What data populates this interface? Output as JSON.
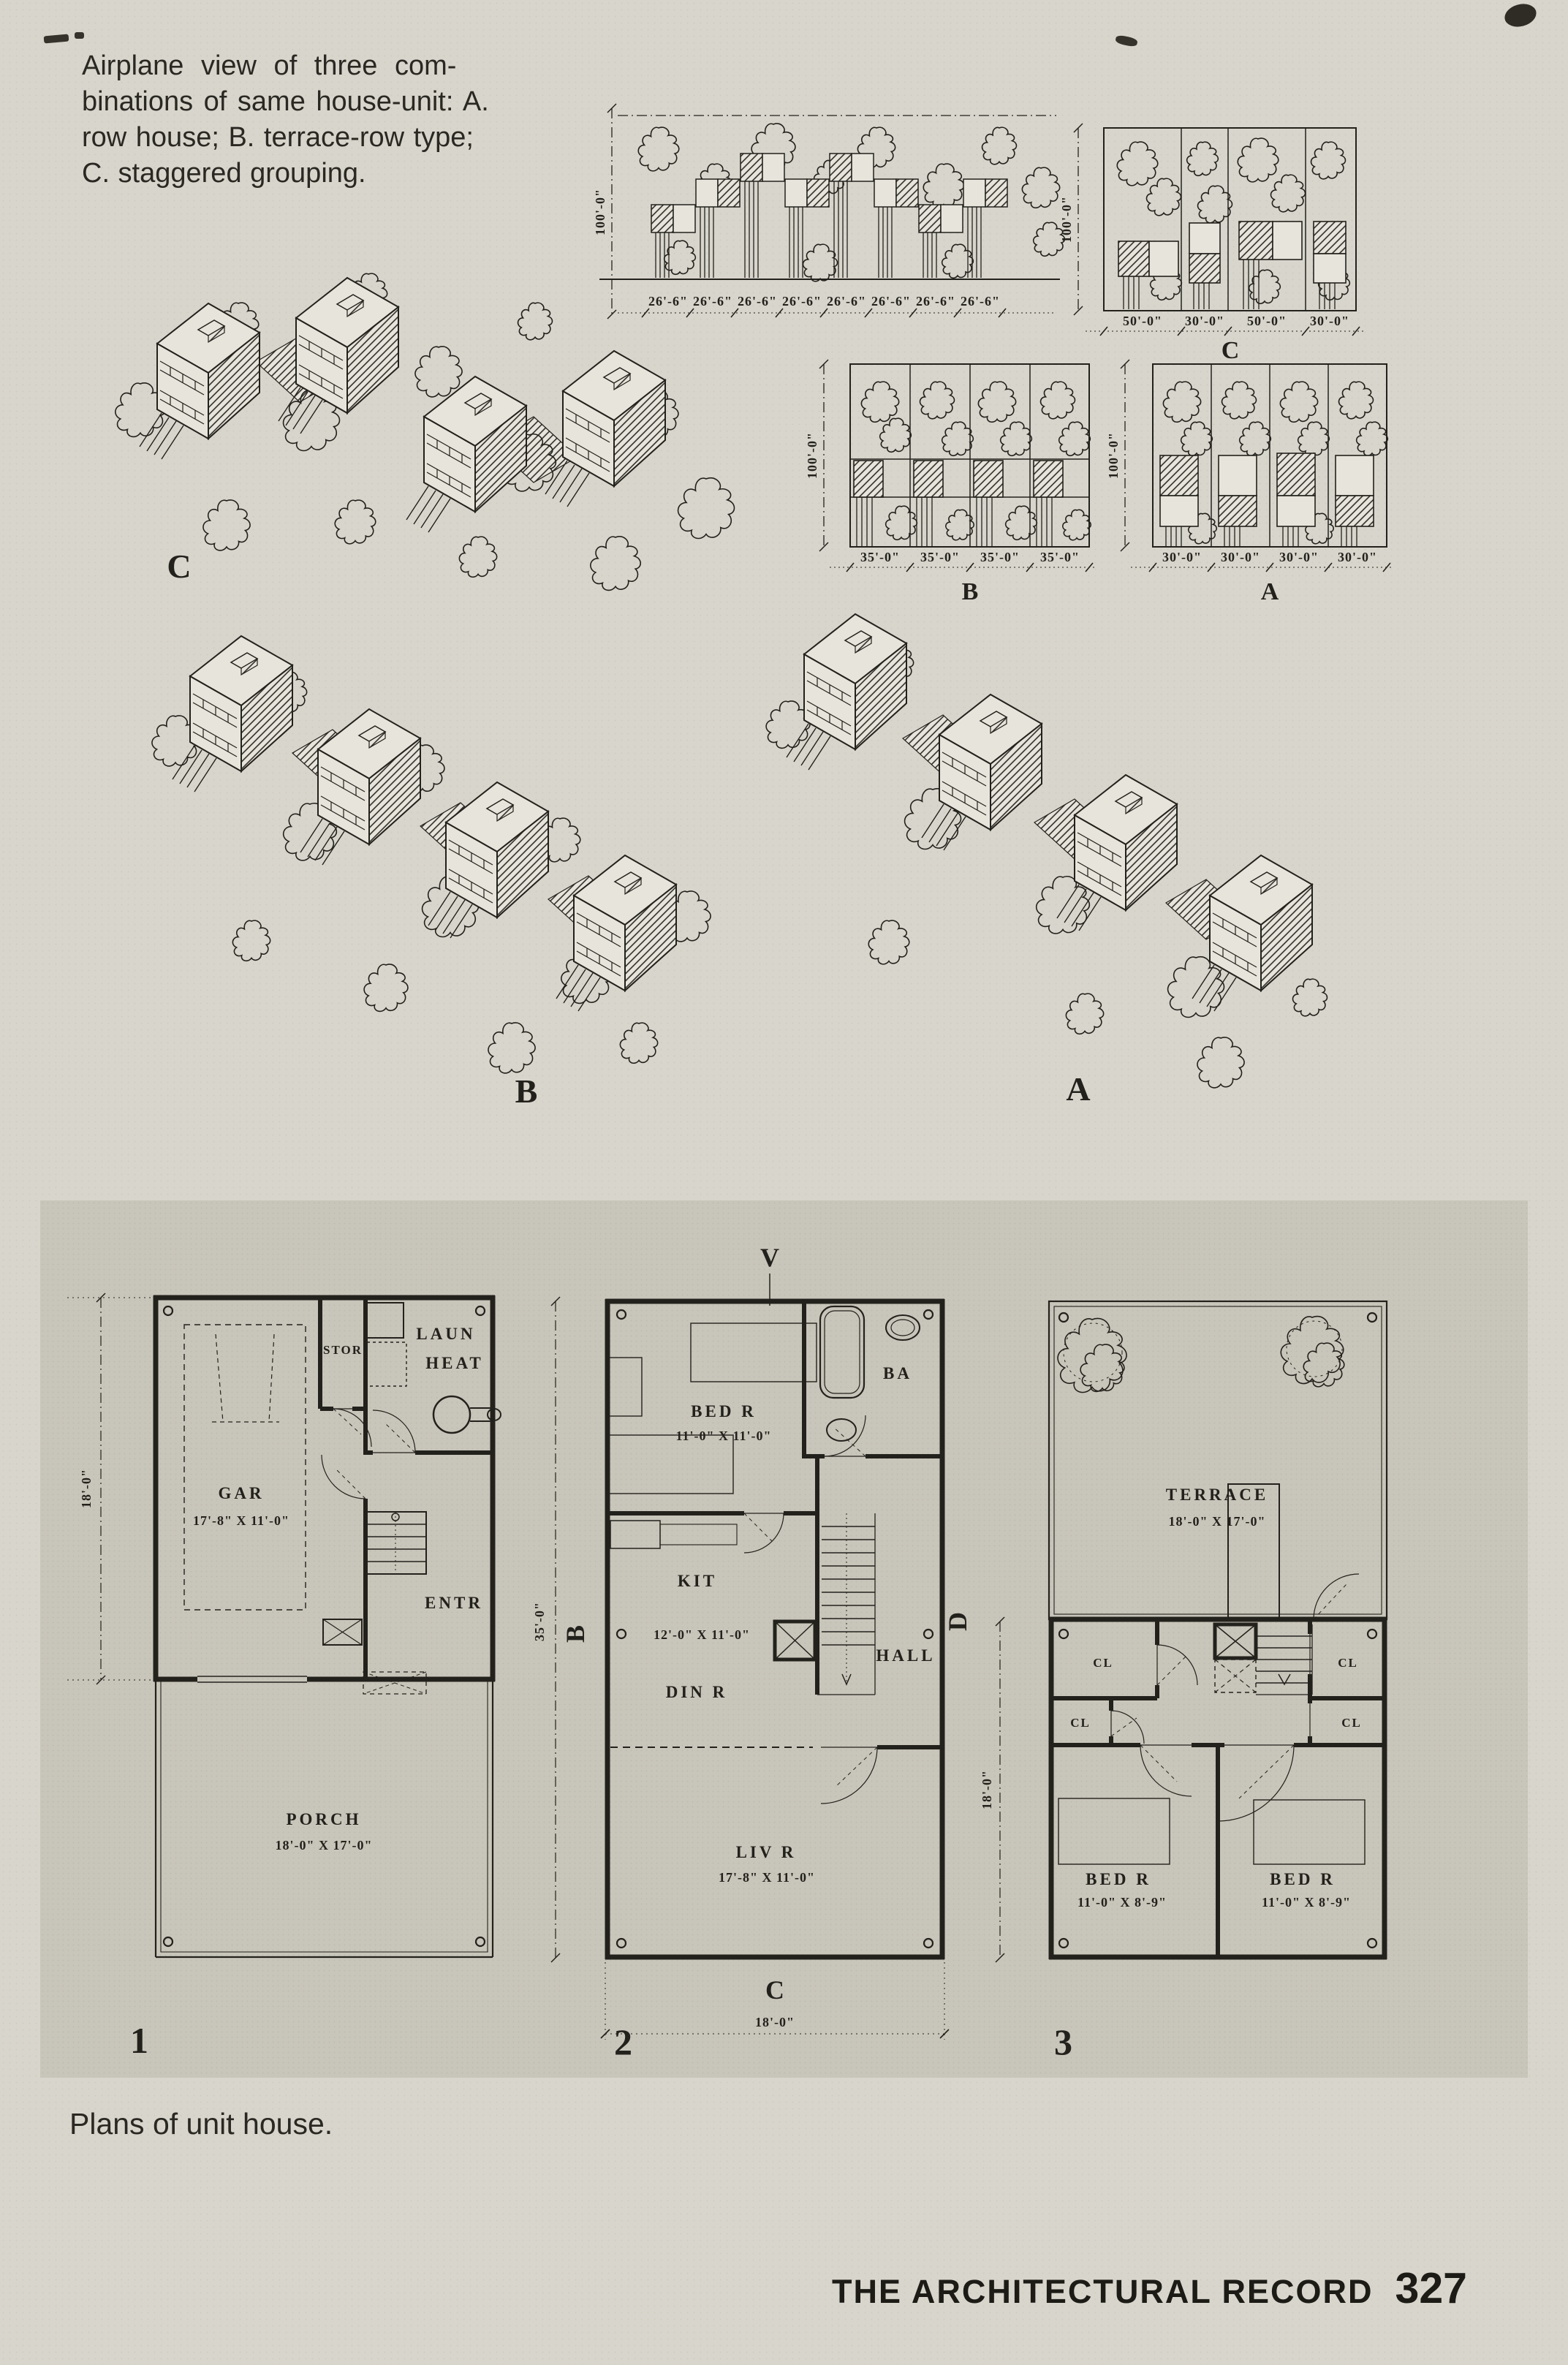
{
  "page": {
    "caption_lines": [
      "Airplane view of three com-",
      "binations of same house-unit: A.",
      "row house; B. terrace-row type;",
      "C. staggered grouping."
    ],
    "plans_caption": "Plans of unit house.",
    "footer_title": "THE ARCHITECTURAL RECORD",
    "footer_page": "327"
  },
  "site_plans": {
    "depth_dim": "100'-0\"",
    "wide": {
      "lots": [
        "26'-6\"",
        "26'-6\"",
        "26'-6\"",
        "26'-6\"",
        "26'-6\"",
        "26'-6\"",
        "26'-6\"",
        "26'-6\""
      ]
    },
    "c": {
      "label": "C",
      "lots": [
        "50'-0\"",
        "30'-0\"",
        "50'-0\"",
        "30'-0\""
      ]
    },
    "b": {
      "label": "B",
      "lots": [
        "35'-0\"",
        "35'-0\"",
        "35'-0\"",
        "35'-0\""
      ]
    },
    "a": {
      "label": "A",
      "lots": [
        "30'-0\"",
        "30'-0\"",
        "30'-0\"",
        "30'-0\""
      ]
    }
  },
  "aerials": {
    "c": "C",
    "b": "B",
    "a": "A"
  },
  "plans": {
    "one": {
      "num": "1",
      "side_dim": "18'-0\"",
      "gar": "GAR",
      "gar_dim": "17'-8\" X 11'-0\"",
      "stor": "STOR",
      "laun": "LAUN",
      "heat": "HEAT",
      "entr": "ENTR",
      "porch": "PORCH",
      "porch_dim": "18'-0\" X 17'-0\""
    },
    "two": {
      "num": "2",
      "marker_top": "V",
      "marker_left": "B",
      "marker_right": "D",
      "marker_bottom": "C",
      "side_dim": "35'-0\"",
      "bottom_dim": "18'-0\"",
      "bed": "BED R",
      "bed_dim": "11'-0\" X 11'-0\"",
      "ba": "BA",
      "kit": "KIT",
      "kit_dim": "12'-0\" X 11'-0\"",
      "din": "DIN R",
      "hall": "HALL",
      "liv": "LIV R",
      "liv_dim": "17'-8\" X 11'-0\""
    },
    "three": {
      "num": "3",
      "side_dim": "18'-0\"",
      "terrace": "TERRACE",
      "terrace_dim": "18'-0\" X 17'-0\"",
      "cl": "CL",
      "bed": "BED R",
      "bed_dim": "11'-0\" X 8'-9\""
    }
  }
}
